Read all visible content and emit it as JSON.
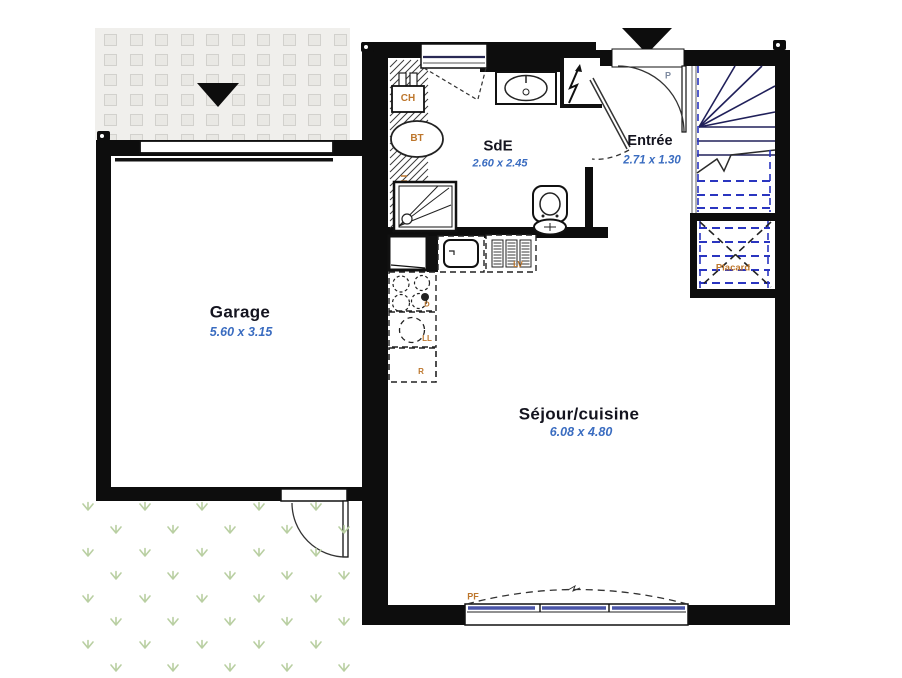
{
  "plan": {
    "rooms": {
      "garage": {
        "name": "Garage",
        "dims": "5.60 x 3.15"
      },
      "sde": {
        "name": "SdE",
        "dims": "2.60 x 2.45"
      },
      "entree": {
        "name": "Entrée",
        "dims": "2.71 x 1.30"
      },
      "sejour": {
        "name": "Séjour/cuisine",
        "dims": "6.08 x 4.80"
      },
      "placard": {
        "name": "Placard"
      }
    },
    "equipment": {
      "ch": "CH",
      "bt": "BT",
      "lv": "LV",
      "ll": "LL",
      "r": "R",
      "d": "D",
      "pf": "PF",
      "door_p": "P"
    },
    "colors": {
      "wall": "#0d0d0d",
      "dims_blue": "#3a6cc0",
      "label_orange": "#bd762c",
      "stair_navy": "#20205a",
      "dashed_blue": "#2a35c0",
      "grass_green": "#b9cfa2",
      "paver_bg": "#f0efec"
    }
  }
}
